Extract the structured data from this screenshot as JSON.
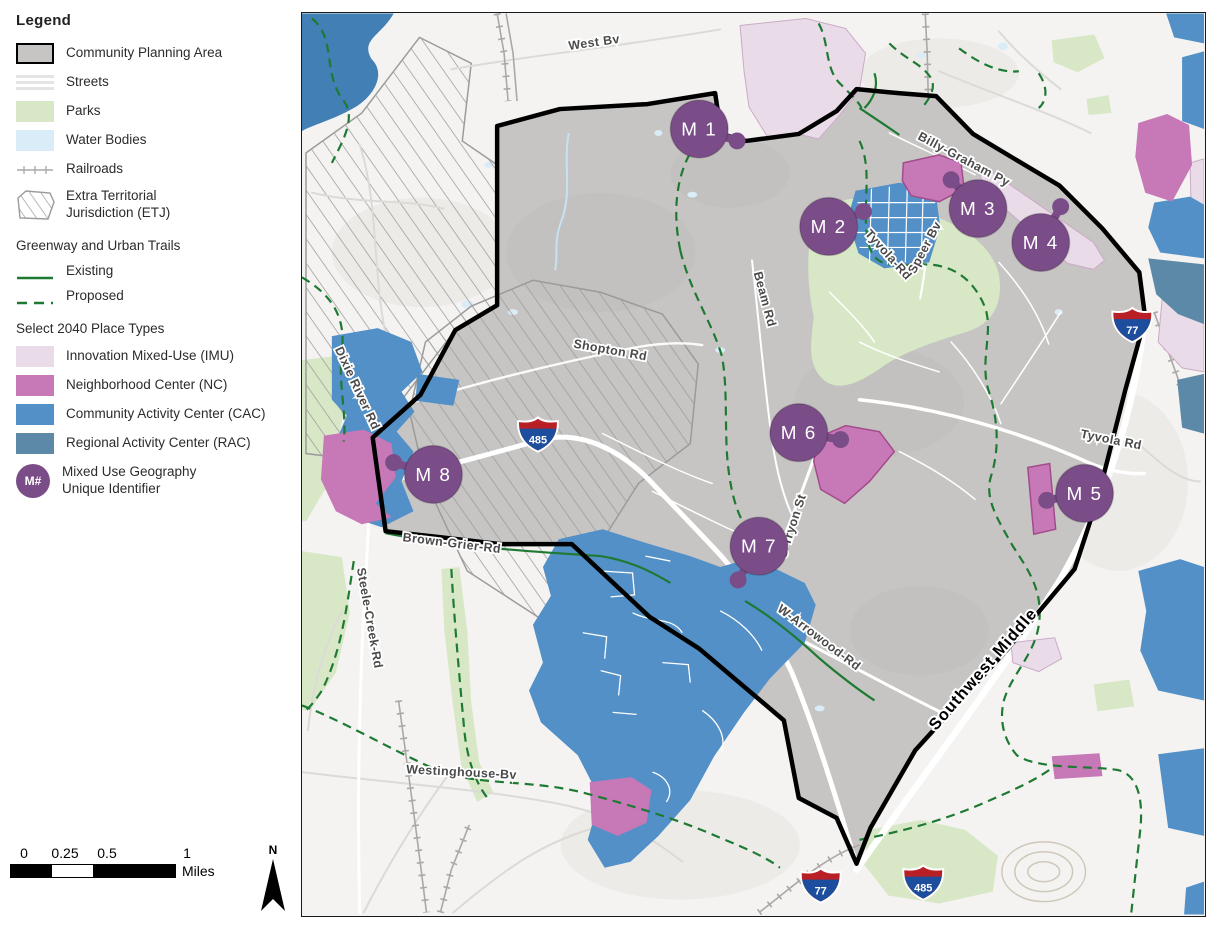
{
  "palette": {
    "planning": "#c7c5c3",
    "parks": "#d8e8c6",
    "water": "#d9ecf7",
    "river": "#417fb5",
    "street_out": "#dcdad7",
    "railroad": "#aaa8a6",
    "trail": "#1e7a33",
    "imu": "#e9dce8",
    "imu_border": "#cbaac7",
    "nc": "#c778b6",
    "nc_border": "#a34b8b",
    "cac": "#5290c7",
    "rac": "#5d89a9",
    "marker": "#7b4d88",
    "road_label": "#4a4a4a",
    "shield_red": "#b92025",
    "shield_blue": "#1d4e9e"
  },
  "legend": {
    "title": "Legend",
    "items": [
      {
        "key": "planning",
        "label": "Community Planning Area"
      },
      {
        "key": "streets",
        "label": "Streets"
      },
      {
        "key": "parks",
        "label": "Parks"
      },
      {
        "key": "water",
        "label": "Water Bodies"
      },
      {
        "key": "railroads",
        "label": "Railroads"
      },
      {
        "key": "etj",
        "label": "Extra Territorial Jurisdiction (ETJ)"
      }
    ],
    "greenway_title": "Greenway and Urban Trails",
    "greenway": [
      {
        "key": "existing",
        "label": "Existing"
      },
      {
        "key": "proposed",
        "label": "Proposed"
      }
    ],
    "place_title": "Select 2040 Place Types",
    "place_items": [
      {
        "key": "imu",
        "label": "Innovation Mixed-Use (IMU)"
      },
      {
        "key": "nc",
        "label": "Neighborhood Center (NC)"
      },
      {
        "key": "cac",
        "label": "Community Activity Center (CAC)"
      },
      {
        "key": "rac",
        "label": "Regional Activity Center (RAC)"
      }
    ],
    "mixed_use": {
      "abbr": "M#",
      "label": "Mixed Use Geography Unique Identifier"
    }
  },
  "scale": {
    "labels": [
      "0",
      "0.25",
      "0.5",
      "1"
    ],
    "unit": "Miles"
  },
  "north": "N",
  "map": {
    "markers": [
      {
        "id": "m1",
        "label": "M 1",
        "x": 399,
        "y": 116,
        "dx": 437,
        "dy": 128
      },
      {
        "id": "m2",
        "label": "M 2",
        "x": 529,
        "y": 214,
        "dx": 564,
        "dy": 199
      },
      {
        "id": "m3",
        "label": "M 3",
        "x": 679,
        "y": 196,
        "dx": 652,
        "dy": 167
      },
      {
        "id": "m4",
        "label": "M 4",
        "x": 742,
        "y": 230,
        "dx": 762,
        "dy": 194
      },
      {
        "id": "m5",
        "label": "M 5",
        "x": 786,
        "y": 482,
        "dx": 748,
        "dy": 489
      },
      {
        "id": "m6",
        "label": "M 6",
        "x": 499,
        "y": 421,
        "dx": 541,
        "dy": 428
      },
      {
        "id": "m7",
        "label": "M 7",
        "x": 459,
        "y": 535,
        "dx": 438,
        "dy": 569
      },
      {
        "id": "m8",
        "label": "M 8",
        "x": 132,
        "y": 463,
        "dx": 92,
        "dy": 451
      }
    ],
    "shields": [
      {
        "num": "485",
        "x": 237,
        "y": 423
      },
      {
        "num": "77",
        "x": 834,
        "y": 313
      },
      {
        "num": "77",
        "x": 521,
        "y": 876
      },
      {
        "num": "485",
        "x": 624,
        "y": 873
      }
    ],
    "road_labels": [
      {
        "text": "West Bv",
        "x": 294,
        "y": 33,
        "rot": -8,
        "cls": "road"
      },
      {
        "text": "Billy-Graham Py",
        "x": 663,
        "y": 150,
        "rot": 28,
        "cls": "road"
      },
      {
        "text": "Speer Bv",
        "x": 629,
        "y": 237,
        "rot": -62,
        "cls": "road"
      },
      {
        "text": "Tyvola-Rd",
        "x": 586,
        "y": 245,
        "rot": 48,
        "cls": "road"
      },
      {
        "text": "Beam Rd",
        "x": 461,
        "y": 288,
        "rot": 75,
        "cls": "road"
      },
      {
        "text": "Shopton Rd",
        "x": 309,
        "y": 342,
        "rot": 10,
        "cls": "road"
      },
      {
        "text": "Dixie River Rd",
        "x": 52,
        "y": 378,
        "rot": 65,
        "cls": "road"
      },
      {
        "text": "Steele-Creek-Rd",
        "x": 64,
        "y": 608,
        "rot": 80,
        "cls": "road"
      },
      {
        "text": "Brown-Grier-Rd",
        "x": 150,
        "y": 536,
        "rot": 7,
        "cls": "road"
      },
      {
        "text": "Westinghouse-Bv",
        "x": 160,
        "y": 766,
        "rot": 3,
        "cls": "road"
      },
      {
        "text": "W-Arrowood-Rd",
        "x": 517,
        "y": 630,
        "rot": 37,
        "cls": "road"
      },
      {
        "text": "S-Tryon St",
        "x": 496,
        "y": 516,
        "rot": -72,
        "cls": "road"
      },
      {
        "text": "Tyvola Rd",
        "x": 812,
        "y": 432,
        "rot": 11,
        "cls": "road"
      },
      {
        "text": "Southwest Middle",
        "x": 688,
        "y": 662,
        "rot": -49,
        "cls": "boundary-label"
      }
    ]
  }
}
